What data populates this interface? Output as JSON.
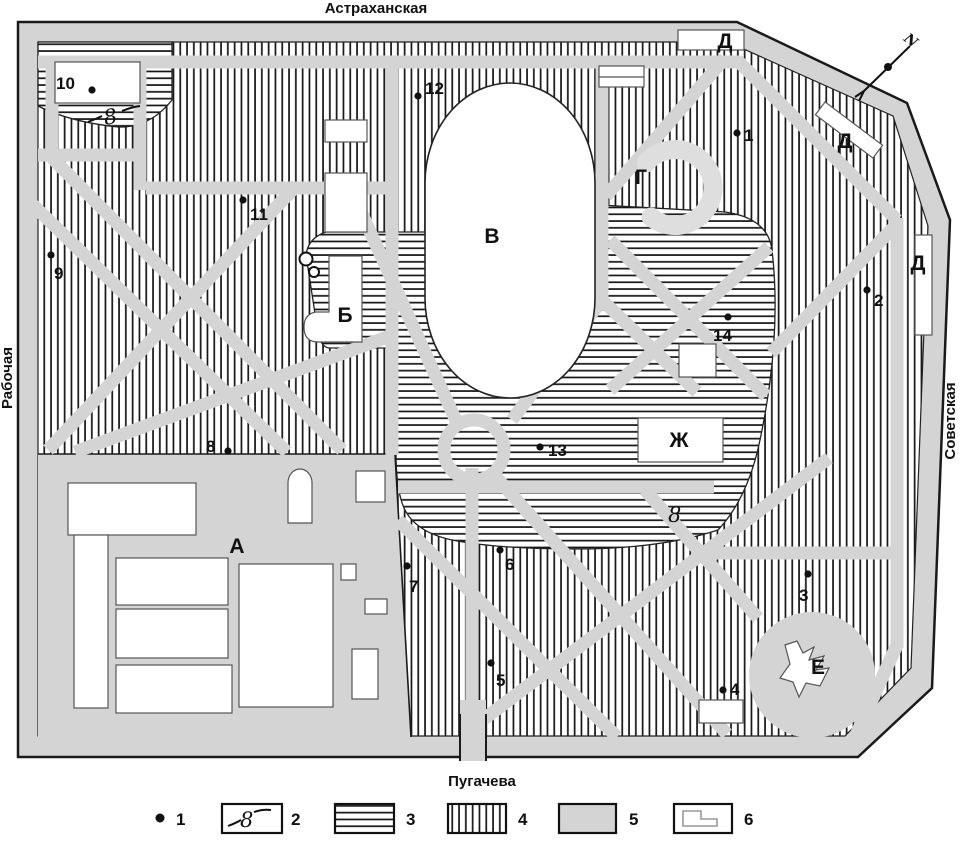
{
  "streets": {
    "top": "Астраханская",
    "bottom": "Пугачева",
    "left": "Рабочая",
    "right": "Советская"
  },
  "compass": {
    "label": "N"
  },
  "areas": [
    {
      "id": "А",
      "x": 237,
      "y": 553
    },
    {
      "id": "Б",
      "x": 345,
      "y": 322
    },
    {
      "id": "В",
      "x": 492,
      "y": 243
    },
    {
      "id": "Г",
      "x": 641,
      "y": 184
    },
    {
      "id": "Д",
      "x": 725,
      "y": 48
    },
    {
      "id": "Д",
      "x": 845,
      "y": 148
    },
    {
      "id": "Д",
      "x": 918,
      "y": 270
    },
    {
      "id": "Е",
      "x": 818,
      "y": 674
    },
    {
      "id": "Ж",
      "x": 679,
      "y": 447
    }
  ],
  "points": [
    {
      "n": "1",
      "dot": [
        737,
        133
      ],
      "label": [
        744,
        141
      ]
    },
    {
      "n": "2",
      "dot": [
        867,
        290
      ],
      "label": [
        874,
        306
      ]
    },
    {
      "n": "3",
      "dot": [
        808,
        574
      ],
      "label": [
        799,
        601
      ]
    },
    {
      "n": "4",
      "dot": [
        723,
        690
      ],
      "label": [
        730,
        695
      ]
    },
    {
      "n": "5",
      "dot": [
        491,
        663
      ],
      "label": [
        496,
        686
      ]
    },
    {
      "n": "6",
      "dot": [
        500,
        550
      ],
      "label": [
        505,
        570
      ]
    },
    {
      "n": "7",
      "dot": [
        407,
        566
      ],
      "label": [
        409,
        592
      ]
    },
    {
      "n": "8",
      "dot": [
        228,
        451
      ],
      "label": [
        206,
        452
      ]
    },
    {
      "n": "9",
      "dot": [
        51,
        255
      ],
      "label": [
        54,
        279
      ]
    },
    {
      "n": "10",
      "dot": [
        92,
        90
      ],
      "label": [
        56,
        89
      ]
    },
    {
      "n": "11",
      "dot": [
        243,
        200
      ],
      "label": [
        250,
        220
      ]
    },
    {
      "n": "12",
      "dot": [
        418,
        96
      ],
      "label": [
        425,
        94
      ]
    },
    {
      "n": "13",
      "dot": [
        540,
        447
      ],
      "label": [
        548,
        456
      ]
    },
    {
      "n": "14",
      "dot": [
        728,
        317
      ],
      "label": [
        713,
        341
      ]
    }
  ],
  "stream_marks": [
    {
      "text": "8",
      "x": 105,
      "y": 125,
      "rot": -10
    },
    {
      "text": "8",
      "x": 668,
      "y": 522,
      "rot": 0
    }
  ],
  "legend": {
    "items": [
      {
        "label": "1",
        "symbol": "dot"
      },
      {
        "label": "2",
        "symbol": "stream",
        "symbol_text": "8"
      },
      {
        "label": "3",
        "symbol": "hhatch"
      },
      {
        "label": "4",
        "symbol": "vhatch"
      },
      {
        "label": "5",
        "symbol": "gray"
      },
      {
        "label": "6",
        "symbol": "building"
      }
    ]
  },
  "colors": {
    "road": "#d4d4d4",
    "outline": "#1a1a1a",
    "hatch": "#141414"
  }
}
